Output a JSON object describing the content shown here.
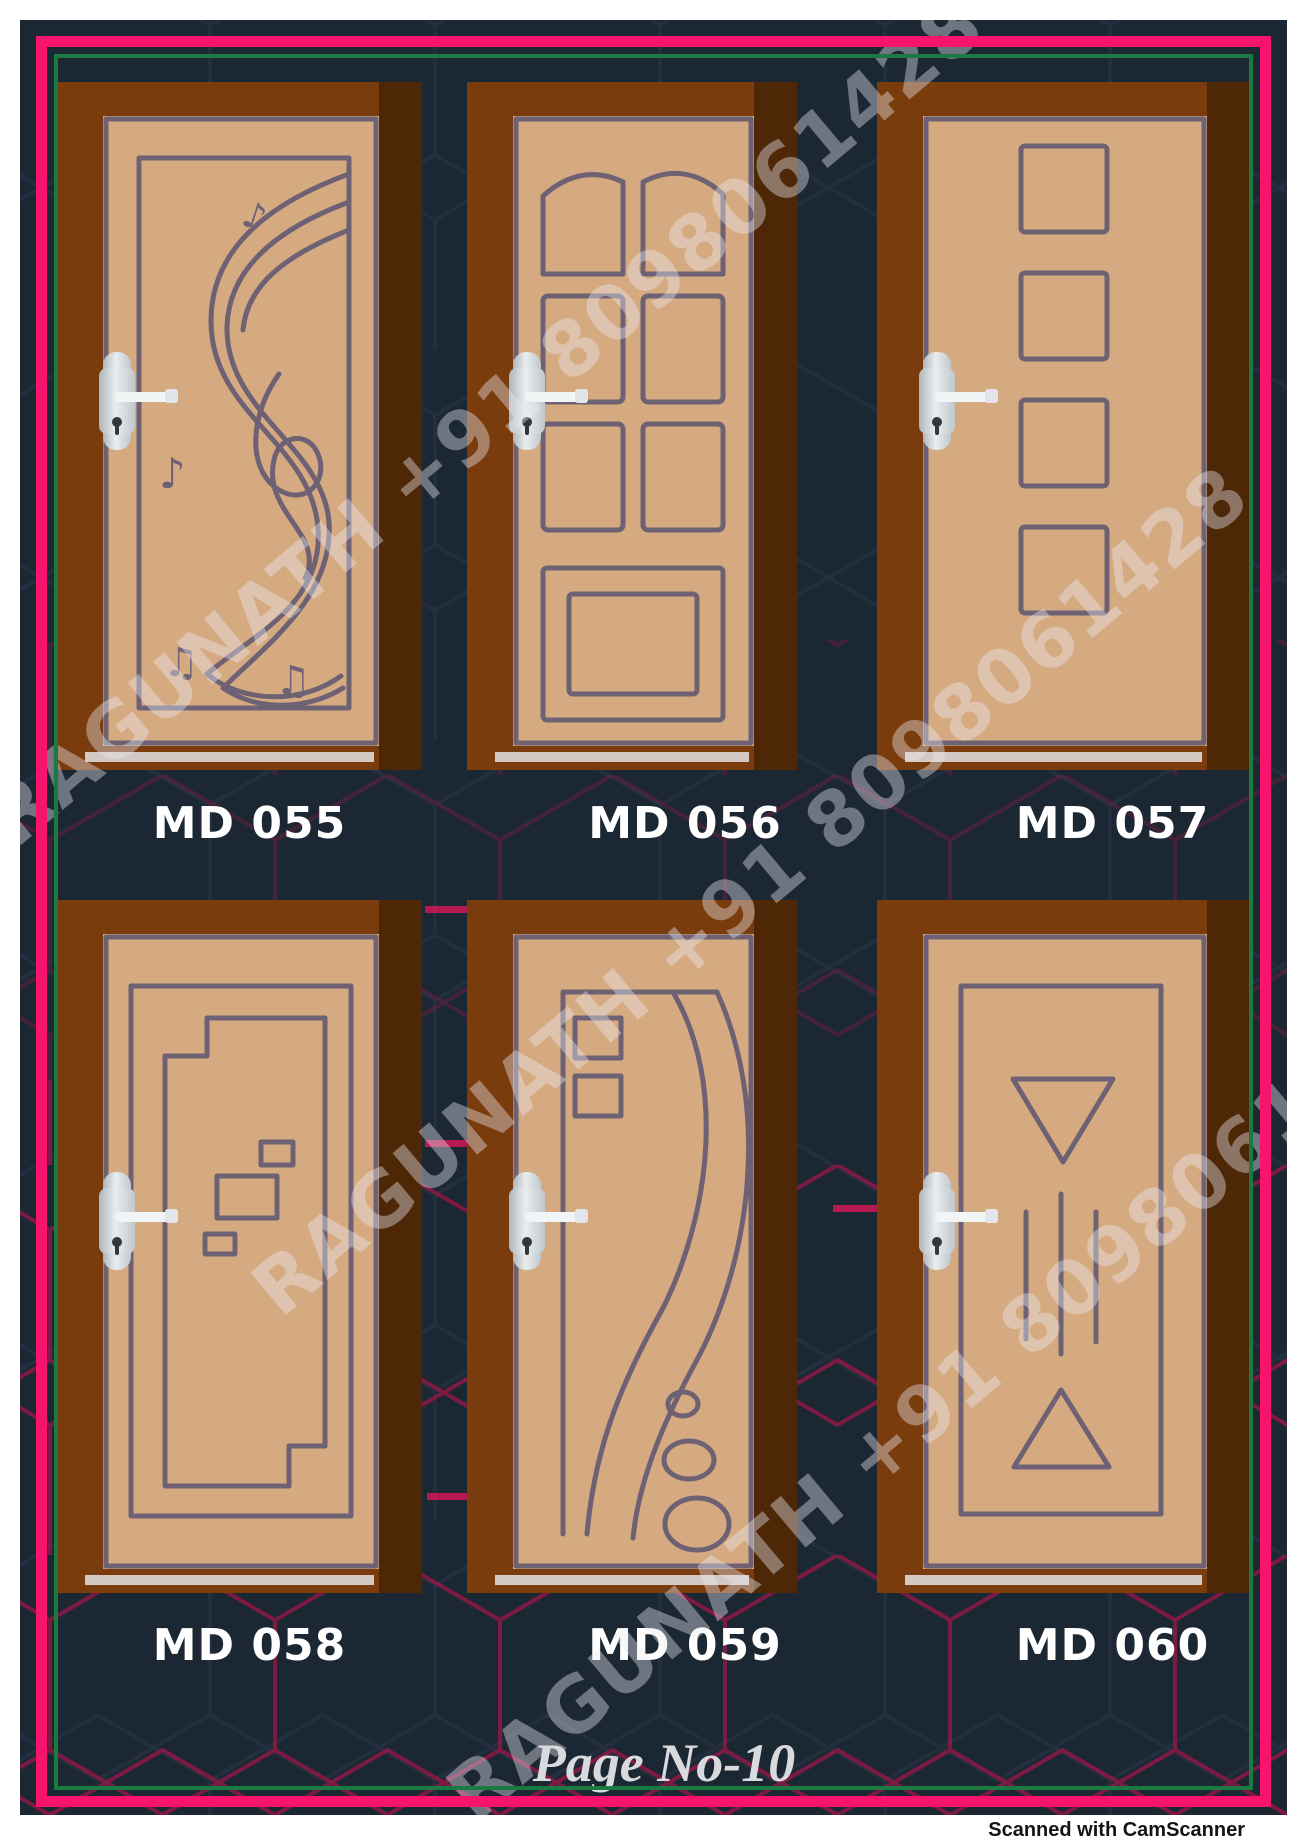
{
  "catalog": {
    "doors": [
      {
        "code": "MD 055",
        "design": "musical-score-engraving"
      },
      {
        "code": "MD 056",
        "design": "arched-eight-panel"
      },
      {
        "code": "MD 057",
        "design": "four-squares-column"
      },
      {
        "code": "MD 058",
        "design": "stepped-nested-rectangles"
      },
      {
        "code": "MD 059",
        "design": "curved-leaf-with-circles"
      },
      {
        "code": "MD 060",
        "design": "triangles-and-vertical-lines"
      }
    ],
    "watermark_text": "RAGUNATH +91 8098061428",
    "page_label": "Page No-10",
    "scan_note": "Scanned with CamScanner",
    "colors": {
      "background_navy": "#1c2734",
      "hex_line_dark": "#232e3e",
      "hex_line_crimson": "#8d1843",
      "border_pink": "#f7146c",
      "border_green": "#1b7a40",
      "frame_brown": "#7a3b0d",
      "frame_shadow_brown": "#4e2706",
      "door_tan": "#d5aa80",
      "engraving_gray": "#6d6173",
      "label_white": "#ffffff"
    }
  }
}
